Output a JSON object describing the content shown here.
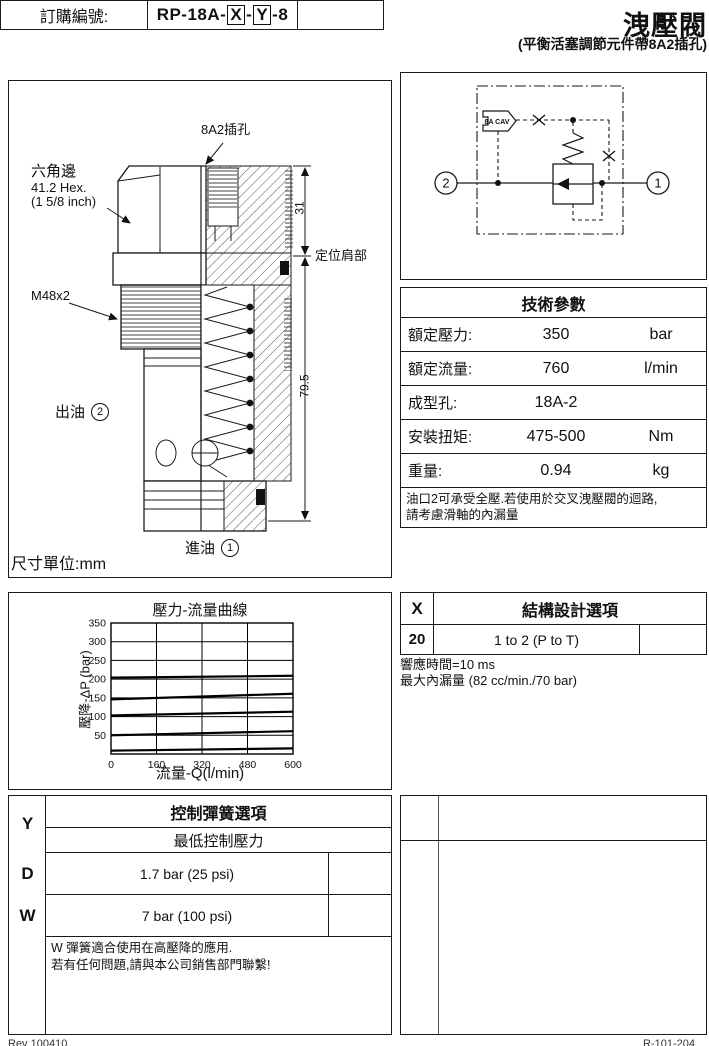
{
  "page": {
    "title": "洩壓閥",
    "subtitle": "(平衡活塞調節元件帶8A2插孔)",
    "footer_left": "Rev 100410",
    "footer_right": "R-101-204"
  },
  "order": {
    "label": "訂購編號:",
    "code_prefix": "RP-18A-",
    "code_x": "X",
    "code_sep": "-",
    "code_y": "Y",
    "code_suffix": "-8"
  },
  "drawing": {
    "cavity_label": "8A2插孔",
    "hex_line1": "六角邊",
    "hex_line2": "41.2 Hex.",
    "hex_line3": "(1 5/8 inch)",
    "thread_label": "M48x2",
    "outlet_label": "出油",
    "outlet_port": "2",
    "inlet_label": "進油",
    "inlet_port": "1",
    "dim_top": "31",
    "dim_total": "79.5",
    "shoulder_label": "定位肩部",
    "units_label": "尺寸單位:mm"
  },
  "schematic": {
    "plug_label": "8A CAV",
    "port_left": "2",
    "port_right": "1"
  },
  "tech_params": {
    "title": "技術參數",
    "rows": [
      {
        "label": "額定壓力:",
        "value": "350",
        "unit": "bar"
      },
      {
        "label": "額定流量:",
        "value": "760",
        "unit": "l/min"
      },
      {
        "label": "成型孔:",
        "value": "18A-2",
        "unit": ""
      },
      {
        "label": "安裝扭矩:",
        "value": "475-500",
        "unit": "Nm"
      },
      {
        "label": "重量:",
        "value": "0.94",
        "unit": "kg"
      }
    ],
    "note_line1": "油口2可承受全壓.若使用於交叉洩壓閥的迴路,",
    "note_line2": "請考慮滑軸的內漏量"
  },
  "chart_data": {
    "type": "line",
    "title": "壓力-流量曲線",
    "xlabel": "流量-Q(l/min)",
    "ylabel": "壓降-ΔP (bar)",
    "xlim": [
      0,
      600
    ],
    "ylim": [
      0,
      350
    ],
    "x_ticks": [
      0,
      160,
      320,
      480,
      600
    ],
    "y_ticks": [
      50,
      100,
      150,
      200,
      250,
      300,
      350
    ],
    "grid": true,
    "legend": false,
    "x": [
      0,
      600
    ],
    "series": [
      {
        "name": "setting-200",
        "values": [
          204,
          209
        ]
      },
      {
        "name": "setting-150",
        "values": [
          146,
          161
        ]
      },
      {
        "name": "setting-100",
        "values": [
          103,
          113
        ]
      },
      {
        "name": "setting-50",
        "values": [
          50,
          61
        ]
      },
      {
        "name": "setting-10",
        "values": [
          9,
          15
        ]
      }
    ]
  },
  "x_options": {
    "key": "X",
    "title": "結構設計選項",
    "rows": [
      {
        "code": "20",
        "desc": "1 to 2 (P to T)"
      }
    ],
    "note_line1": "響應時間=10 ms",
    "note_line2": "最大內漏量 (82 cc/min./70 bar)"
  },
  "y_options": {
    "key": "Y",
    "title": "控制彈簧選項",
    "subtitle": "最低控制壓力",
    "rows": [
      {
        "code": "D",
        "desc": "1.7 bar (25 psi)"
      },
      {
        "code": "W",
        "desc": "7 bar (100 psi)"
      }
    ],
    "note_line1": "W 彈簧適合使用在高壓降的應用.",
    "note_line2": "若有任何問題,請與本公司銷售部門聯繫!"
  }
}
